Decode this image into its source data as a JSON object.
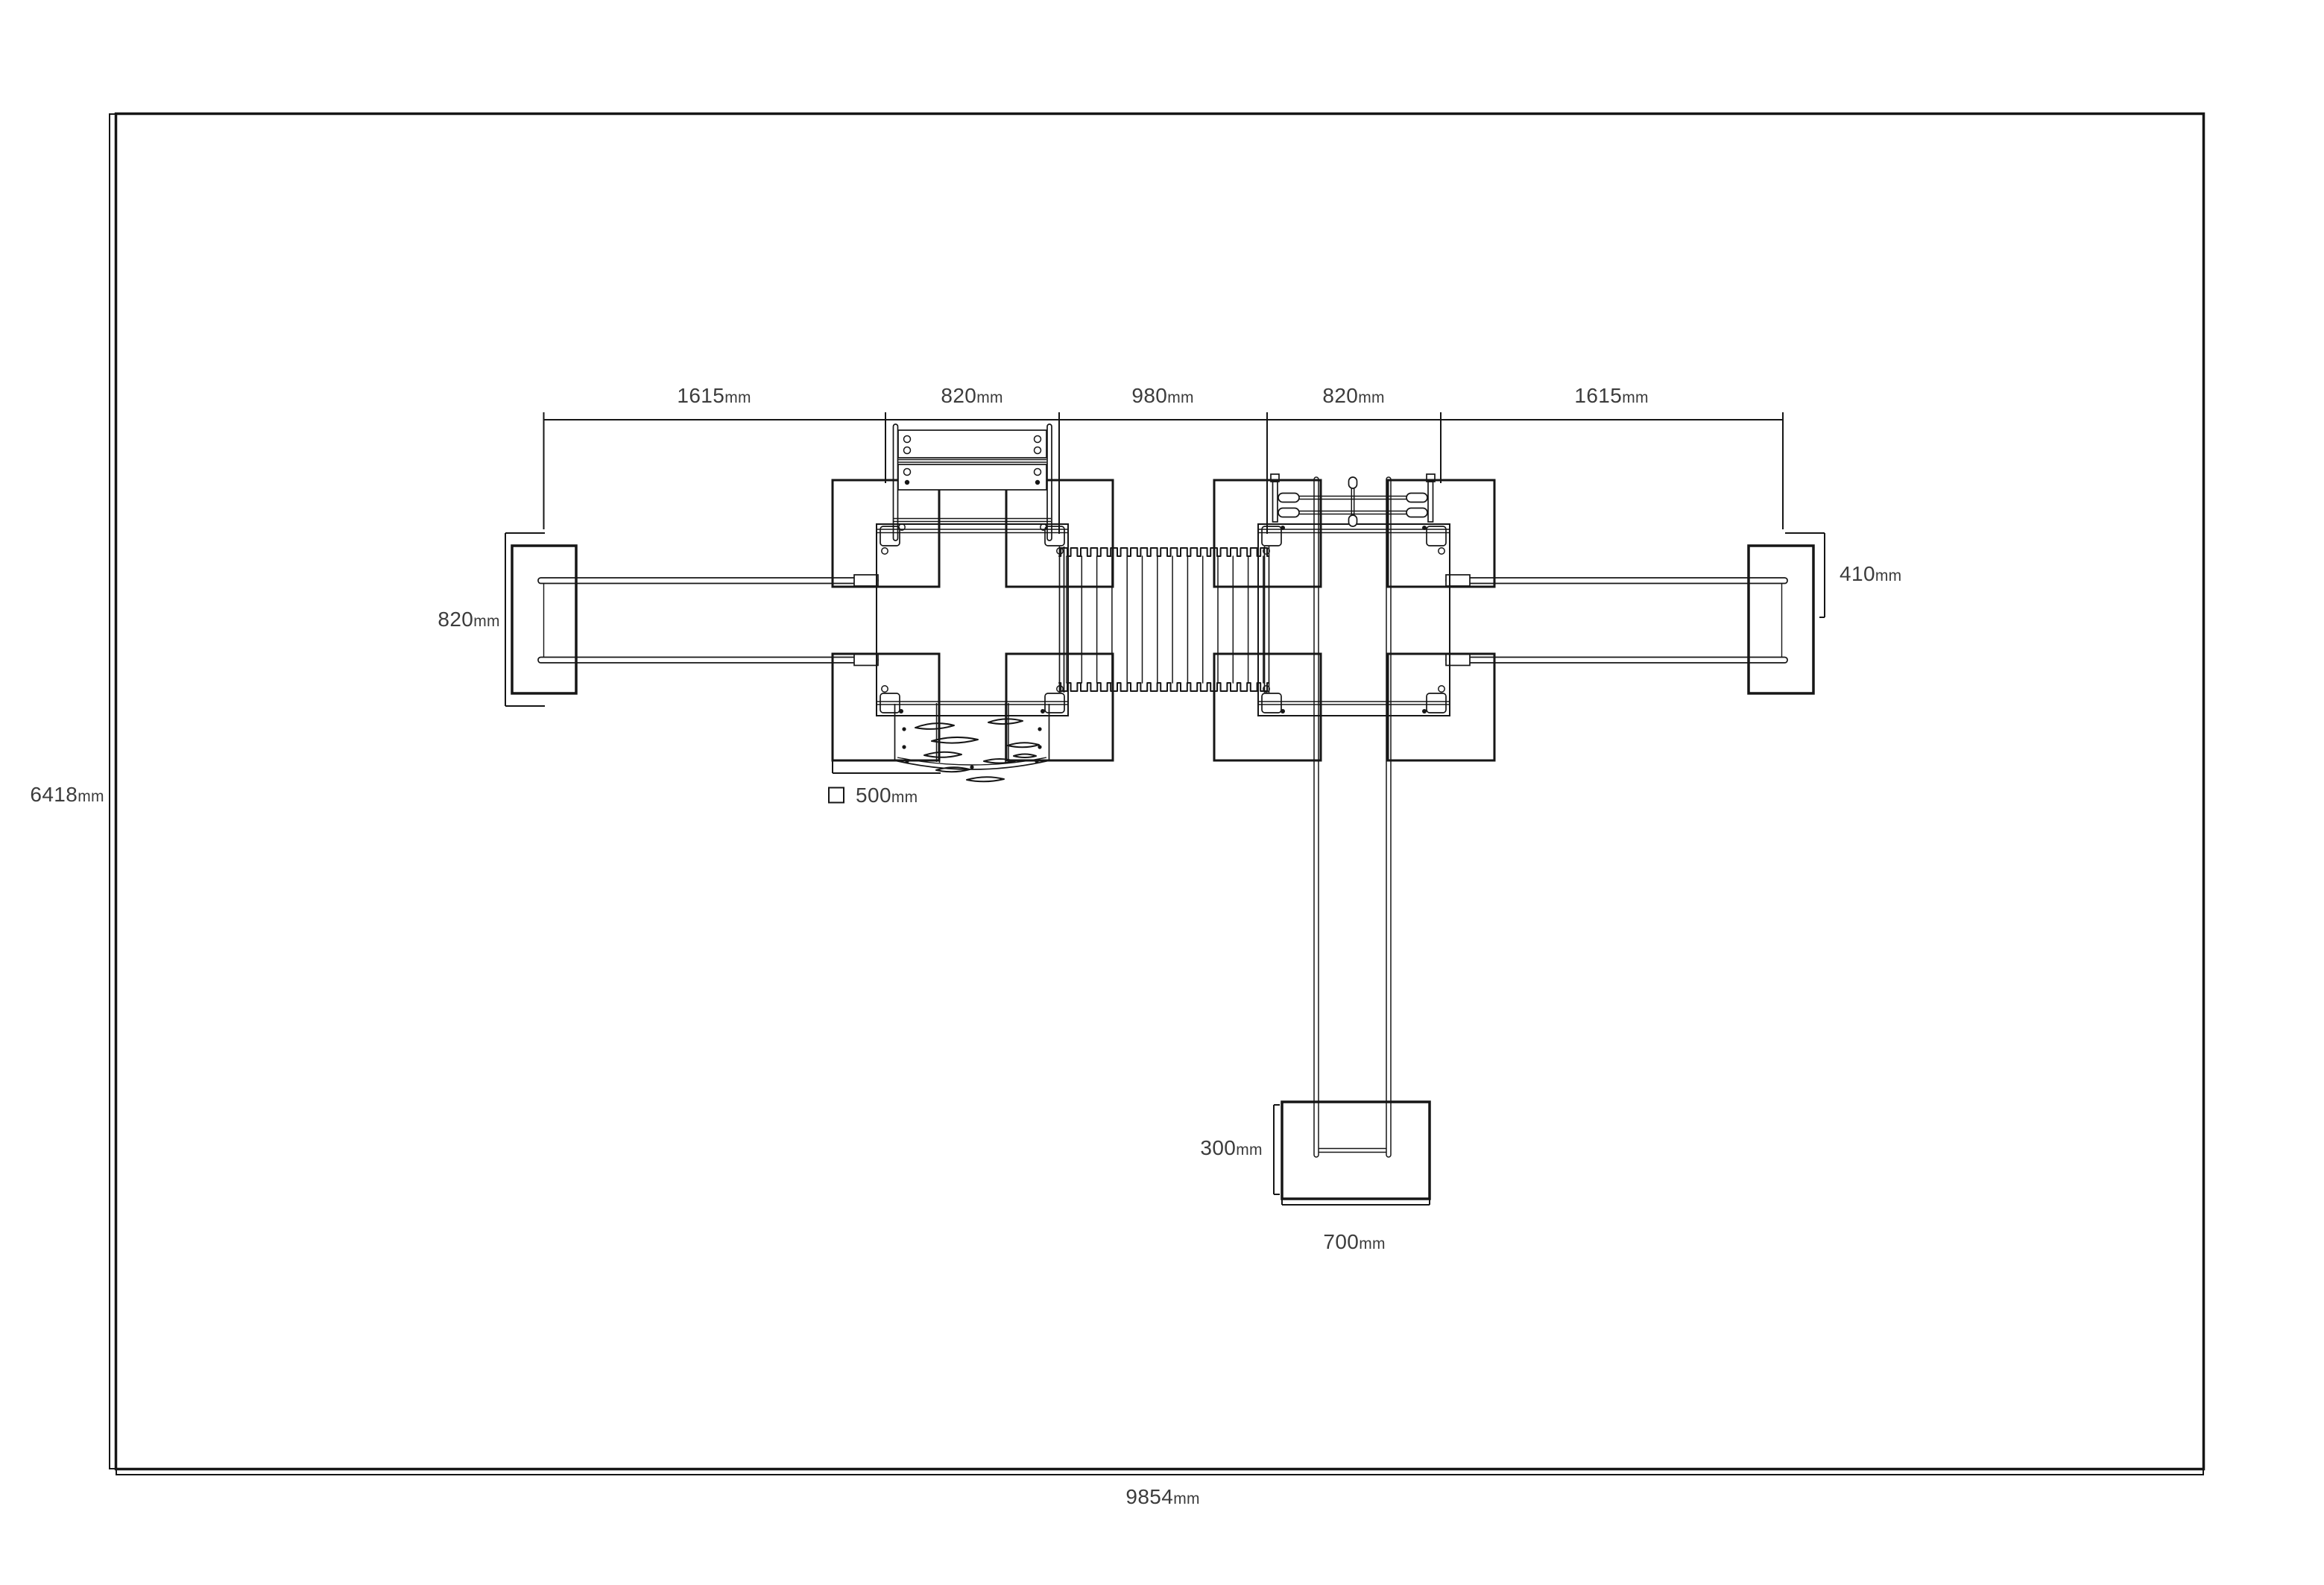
{
  "unit": "mm",
  "overall": {
    "width": "9854",
    "height": "6418"
  },
  "top_chain": [
    {
      "value": "1615"
    },
    {
      "value": "820"
    },
    {
      "value": "980"
    },
    {
      "value": "820"
    },
    {
      "value": "1615"
    }
  ],
  "left_beam_dim": {
    "value": "820"
  },
  "right_beam_dim": {
    "value": "410"
  },
  "post_legend": {
    "value": "500"
  },
  "slide_exit": {
    "depth": {
      "value": "300"
    },
    "width": {
      "value": "700"
    }
  },
  "colors": {
    "background": "#ffffff",
    "line": "#161616",
    "dimension_line": "#c6c6c6",
    "text": "#3c3c3c"
  }
}
